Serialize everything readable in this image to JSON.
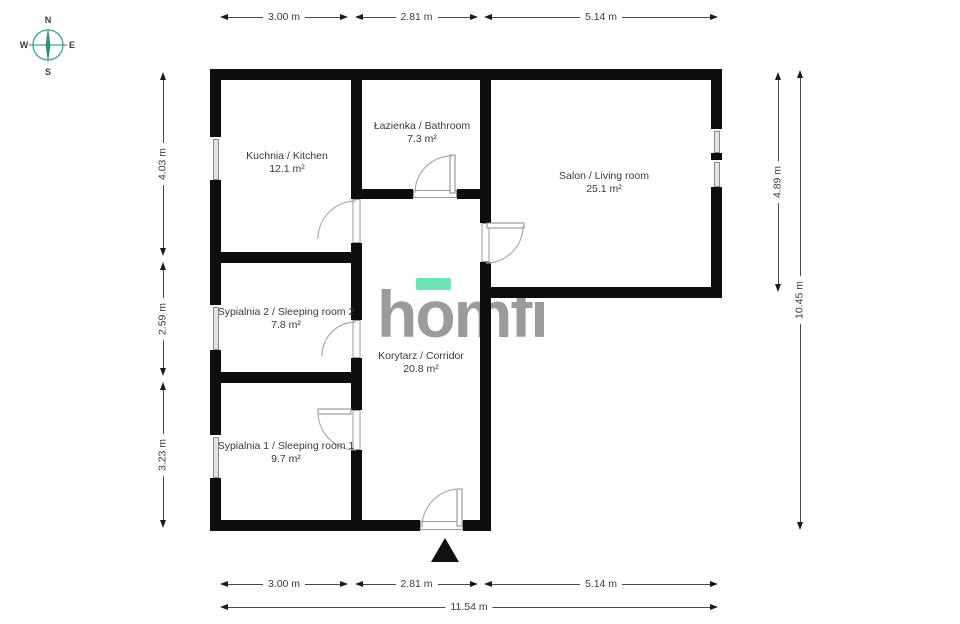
{
  "compass": {
    "north": "N",
    "south": "S",
    "east": "E",
    "west": "W"
  },
  "logo": {
    "letters": [
      "h",
      "o",
      "m",
      "f",
      "i"
    ],
    "accent_color": "#6fe3b4",
    "text_color": "#9b9b9b"
  },
  "rooms": [
    {
      "name": "Kuchnia / Kitchen",
      "area": "12.1 m²"
    },
    {
      "name": "Łazienka / Bathroom",
      "area": "7.3 m²"
    },
    {
      "name": "Salon / Living room",
      "area": "25.1 m²"
    },
    {
      "name": "Sypialnia 2 / Sleeping room 2",
      "area": "7.8 m²"
    },
    {
      "name": "Korytarz / Corridor",
      "area": "20.8 m²"
    },
    {
      "name": "Sypialnia 1 / Sleeping room 1",
      "area": "9.7 m²"
    }
  ],
  "dimensions": {
    "top": [
      "3.00 m",
      "2.81 m",
      "5.14 m"
    ],
    "bottom": [
      "3.00 m",
      "2.81 m",
      "5.14 m"
    ],
    "bottom_total": "11.54 m",
    "left": [
      "4.03 m",
      "2.59 m",
      "3.23 m"
    ],
    "right": [
      "4.89 m",
      "10.45 m"
    ]
  },
  "icons": [
    "compass-rose-icon",
    "entrance-arrow-icon",
    "door-swing-icon",
    "window-icon"
  ],
  "colors": {
    "wall": "#0d0d0d",
    "logo_gray": "#9b9b9b",
    "logo_accent": "#6fe3b4",
    "compass_teal": "#3fa18f",
    "dim_text": "#3c3c3c"
  }
}
